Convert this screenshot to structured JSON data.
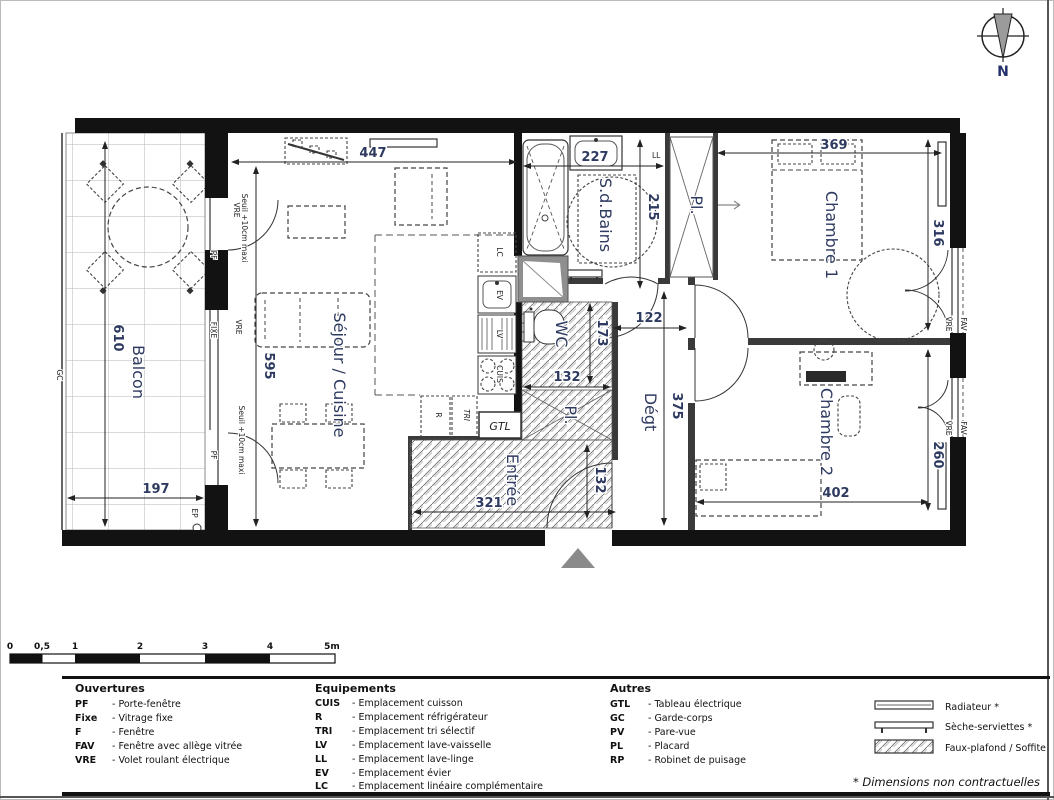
{
  "plan": {
    "rooms": {
      "balcon": "Balcon",
      "sejour": "Séjour / Cuisine",
      "sdb": "S.d.Bains",
      "wc": "WC",
      "pl": "Pl.",
      "degt": "Dégt",
      "entree": "Entrée",
      "ch1": "Chambre 1",
      "ch2": "Chambre 2"
    },
    "dims": {
      "d447": "447",
      "d227": "227",
      "d369": "369",
      "d610": "610",
      "d595": "595",
      "d197": "197",
      "d215": "215",
      "d316": "316",
      "d122": "122",
      "d132": "132",
      "d173": "173",
      "d321": "321",
      "d375": "375",
      "d402": "402",
      "d260": "260"
    },
    "labels": {
      "pf": "PF",
      "fixe": "FIXE",
      "vre": "VRE",
      "fav": "FAV",
      "gc": "GC",
      "ep": "EP",
      "ll": "LL",
      "lc": "LC",
      "ev": "EV",
      "lv": "LV",
      "cuis": "CUIS",
      "r": "R",
      "tri": "TRI",
      "gtl": "GTL",
      "seuil": "Seuil +10cm maxi",
      "north": "N"
    }
  },
  "scalebar": {
    "t0": "0",
    "t05": "0,5",
    "t1": "1",
    "t2": "2",
    "t3": "3",
    "t4": "4",
    "t5": "5m"
  },
  "legend": {
    "columns": [
      {
        "title": "Ouvertures",
        "items": [
          {
            "abbr": "PF",
            "desc": "- Porte-fenêtre"
          },
          {
            "abbr": "Fixe",
            "desc": "- Vitrage fixe"
          },
          {
            "abbr": "F",
            "desc": "- Fenêtre"
          },
          {
            "abbr": "FAV",
            "desc": "- Fenêtre avec allège vitrée"
          },
          {
            "abbr": "VRE",
            "desc": "- Volet roulant électrique"
          }
        ]
      },
      {
        "title": "Equipements",
        "items": [
          {
            "abbr": "CUIS",
            "desc": "- Emplacement  cuisson"
          },
          {
            "abbr": "R",
            "desc": "- Emplacement réfrigérateur"
          },
          {
            "abbr": "TRI",
            "desc": "- Emplacement tri sélectif"
          },
          {
            "abbr": "LV",
            "desc": "- Emplacement lave-vaisselle"
          },
          {
            "abbr": "LL",
            "desc": "- Emplacement lave-linge"
          },
          {
            "abbr": "EV",
            "desc": "- Emplacement évier"
          },
          {
            "abbr": "LC",
            "desc": "- Emplacement linéaire complémentaire"
          }
        ]
      },
      {
        "title": "Autres",
        "items": [
          {
            "abbr": "GTL",
            "desc": "- Tableau électrique"
          },
          {
            "abbr": "GC",
            "desc": "- Garde-corps"
          },
          {
            "abbr": "PV",
            "desc": "- Pare-vue"
          },
          {
            "abbr": "PL",
            "desc": "- Placard"
          },
          {
            "abbr": "RP",
            "desc": "- Robinet de puisage"
          }
        ]
      }
    ],
    "symbols": [
      {
        "label": "Radiateur *"
      },
      {
        "label": "Sèche-serviettes *"
      },
      {
        "label": "Faux-plafond / Soffite"
      }
    ],
    "footnote": "* Dimensions non contractuelles"
  }
}
